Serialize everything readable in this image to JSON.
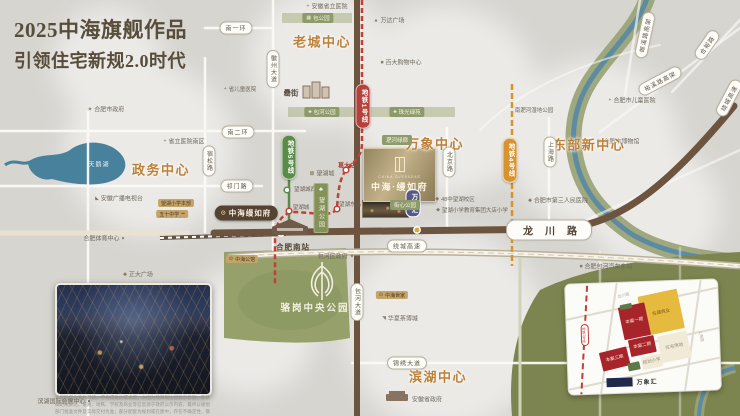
{
  "title": {
    "line1": "2025中海旗舰作品",
    "line2": "引领住宅新规2.0时代"
  },
  "logo": {
    "en": "CHINA OVERSEAS",
    "cn": "中海·缦如府"
  },
  "photo": {
    "caption": "本资料仅为要约邀请，不构成要约或承诺；本图为项目周边配套示意图，非精确距离表达，道路、地铁、学校及商业等信息源于政府公示内容，最终以规划部门批准文件及实际交付为准；部分配套为规划或在建中，存在不确定性，敬请知悉。"
  },
  "inset": {
    "mall_label": "万象汇",
    "metro_label": "地铁1号线",
    "roads": [
      {
        "t": "龙川路",
        "x": 58,
        "y": 13,
        "rot": -12
      },
      {
        "t": "上海路",
        "x": 134,
        "y": 56,
        "rot": 80
      }
    ],
    "parcels": [
      {
        "t": "在建商业",
        "x": 95,
        "y": 31,
        "w": 40,
        "h": 40,
        "c": "#e6b93f",
        "tc": "#7a5a18",
        "rot": -10
      },
      {
        "t": "本案一期",
        "x": 68,
        "y": 39,
        "w": 27,
        "h": 33,
        "c": "#a8242b",
        "tc": "#f7e9da",
        "rot": -10
      },
      {
        "t": "本案二期",
        "x": 75,
        "y": 64,
        "w": 26,
        "h": 17,
        "c": "#a8242b",
        "tc": "#f7e9da",
        "rot": -10
      },
      {
        "t": "本案三期",
        "x": 47,
        "y": 76,
        "w": 28,
        "h": 19,
        "c": "#a8242b",
        "tc": "#f7e9da",
        "rot": -12
      },
      {
        "t": "住宅用地",
        "x": 107,
        "y": 66,
        "w": 30,
        "h": 27,
        "c": "#f1ead6",
        "tc": "#9a8e76",
        "rot": -10
      },
      {
        "t": "规划小学",
        "x": 84,
        "y": 80,
        "w": 20,
        "h": 13,
        "c": "#f1ead6",
        "tc": "#9a8e76",
        "rot": -10
      },
      {
        "t": "",
        "x": 66,
        "y": 84,
        "w": 12,
        "h": 8,
        "c": "#5d7a46",
        "tc": "#ffffff",
        "rot": -10
      },
      {
        "t": "",
        "x": 60,
        "y": 24,
        "w": 12,
        "h": 5,
        "c": "#5d7a46",
        "tc": "#ffffff",
        "rot": -10
      }
    ]
  },
  "map": {
    "labels": [
      {
        "t": "安徽省立医院",
        "i": "+",
        "x": 327,
        "y": 6
      },
      {
        "t": "万达广场",
        "i": "▲",
        "x": 389,
        "y": 20
      },
      {
        "t": "百大购物中心",
        "i": "■",
        "x": 401,
        "y": 62
      },
      {
        "t": "合肥市儿童医院",
        "i": "+",
        "x": 632,
        "y": 100
      },
      {
        "t": "省儿童医院",
        "i": "+",
        "x": 240,
        "y": 89,
        "fs": 5.5
      },
      {
        "t": "合肥市政府",
        "i": "★",
        "x": 106,
        "y": 109
      },
      {
        "t": "省立医院南区",
        "i": "+",
        "x": 184,
        "y": 141
      },
      {
        "t": "安徽广播电视台",
        "i": "◣",
        "x": 119,
        "y": 198
      },
      {
        "t": "合肥体育中心",
        "i2": "●",
        "x": 104,
        "y": 238
      },
      {
        "t": "正大广场",
        "i": "◆",
        "x": 138,
        "y": 274
      },
      {
        "t": "包河区政府",
        "i2": "★",
        "x": 336,
        "y": 256
      },
      {
        "t": "合肥市博物馆",
        "i": "▦",
        "x": 618,
        "y": 141
      },
      {
        "t": "合肥市第三人民医院",
        "i": "◆",
        "x": 558,
        "y": 200
      },
      {
        "t": "南淝河湿地公园",
        "x": 534,
        "y": 110,
        "fs": 5.5
      },
      {
        "t": "合肥包河汽车东站",
        "i": "■",
        "x": 606,
        "y": 266
      },
      {
        "t": "华夏茶博城",
        "i": "◥",
        "x": 400,
        "y": 318
      },
      {
        "t": "安徽省政府",
        "x": 427,
        "y": 399
      },
      {
        "t": "滨湖国际会展中心",
        "i2": "●",
        "x": 64,
        "y": 401
      },
      {
        "t": "48中望湖校区",
        "i": "◆",
        "x": 455,
        "y": 199,
        "fs": 5.5
      },
      {
        "t": "望湖小学教育集团大店小学",
        "i": "◆",
        "x": 472,
        "y": 210,
        "fs": 5.5
      },
      {
        "t": "望湖城",
        "i": "▦",
        "x": 322,
        "y": 173
      },
      {
        "t": "罍街",
        "x": 291,
        "y": 93,
        "fs": 7.5,
        "cls": "poi strong"
      },
      {
        "t": "葛大店",
        "x": 347,
        "y": 165,
        "cls": "rsta"
      },
      {
        "t": "望湖城西",
        "x": 305,
        "y": 189,
        "cls": "sta"
      },
      {
        "t": "望湖城",
        "x": 301,
        "y": 207,
        "cls": "sta"
      },
      {
        "t": "望湖东路",
        "x": 350,
        "y": 204,
        "cls": "sta"
      },
      {
        "t": "合肥南站",
        "x": 293,
        "y": 247,
        "cls": "sta big-sta"
      },
      {
        "t": "老城中心",
        "x": 322,
        "y": 41,
        "cls": "center"
      },
      {
        "t": "万象中心",
        "x": 435,
        "y": 143,
        "cls": "center"
      },
      {
        "t": "东部新中心",
        "x": 589,
        "y": 144,
        "cls": "center"
      },
      {
        "t": "政务中心",
        "x": 161,
        "y": 169,
        "cls": "center"
      },
      {
        "t": "滨湖中心",
        "x": 438,
        "y": 376,
        "cls": "center"
      },
      {
        "t": "骆岗中央公园",
        "x": 315,
        "y": 307,
        "cls": "park-title"
      },
      {
        "t": "天鹅湖",
        "x": 99,
        "y": 164,
        "cls": "lake-title"
      },
      {
        "t": "南一环",
        "x": 236,
        "y": 28,
        "cls": "hp"
      },
      {
        "t": "南二环",
        "x": 238,
        "y": 132,
        "cls": "hp"
      },
      {
        "t": "祁门路",
        "x": 237,
        "y": 186,
        "cls": "hp"
      },
      {
        "t": "绕城高速",
        "x": 407,
        "y": 246,
        "cls": "hp"
      },
      {
        "t": "锦绣大道",
        "x": 407,
        "y": 363,
        "cls": "hp"
      },
      {
        "t": "龙川路",
        "x": 549,
        "y": 230,
        "cls": "hp big"
      },
      {
        "t": "徽州大道",
        "x": 273,
        "y": 69,
        "cls": "vp"
      },
      {
        "t": "宿松路",
        "x": 209,
        "y": 161,
        "cls": "vp"
      },
      {
        "t": "包河大道",
        "x": 357,
        "y": 302,
        "cls": "vp"
      },
      {
        "t": "北京路",
        "x": 449,
        "y": 162,
        "cls": "vp"
      },
      {
        "t": "上海路",
        "x": 550,
        "y": 152,
        "cls": "vp"
      },
      {
        "t": "郎溪路高架",
        "x": 645,
        "y": 35,
        "cls": "hp",
        "rot": -78
      },
      {
        "t": "裕溪路高架",
        "x": 660,
        "y": 81,
        "cls": "hp",
        "rot": -28
      },
      {
        "t": "合裕路",
        "x": 707,
        "y": 45,
        "cls": "hp",
        "rot": -55
      },
      {
        "t": "绕城高速",
        "x": 729,
        "y": 98,
        "cls": "hp",
        "rot": -62
      },
      {
        "t": "地铁1号线",
        "x": 363,
        "y": 106,
        "cls": "metro",
        "c": "#b5413a"
      },
      {
        "t": "地铁5号线",
        "x": 289,
        "y": 157,
        "cls": "metro",
        "c": "#5b8a4a"
      },
      {
        "t": "地铁4号线",
        "x": 510,
        "y": 160,
        "cls": "metro",
        "c": "#d6932f"
      },
      {
        "t": "万象汇",
        "x": 413,
        "y": 203,
        "cls": "mall-pill"
      },
      {
        "t": "包公园",
        "i": "▦",
        "x": 318,
        "y": 18,
        "cls": "pp"
      },
      {
        "t": "包河公园",
        "i": "♣",
        "x": 322,
        "y": 112,
        "cls": "pp"
      },
      {
        "t": "珠光绿苑",
        "i": "♣",
        "x": 407,
        "y": 112,
        "cls": "pp"
      },
      {
        "t": "淝河绿廊",
        "x": 397,
        "y": 140,
        "cls": "pp"
      },
      {
        "t": "街心公园",
        "x": 405,
        "y": 205,
        "cls": "pp"
      },
      {
        "t": "望湖公园",
        "i": "♣",
        "x": 321,
        "y": 208,
        "cls": "park-block"
      },
      {
        "t": "望湖小学本部",
        "x": 176,
        "y": 203,
        "cls": "gp"
      },
      {
        "t": "五十中学",
        "i2": "▪▪",
        "x": 172,
        "y": 214,
        "cls": "gp"
      },
      {
        "t": "中海公馆",
        "i": "⊙",
        "x": 242,
        "y": 259,
        "cls": "gp"
      },
      {
        "t": "中海世家",
        "i": "⊙",
        "x": 392,
        "y": 295,
        "cls": "gp"
      },
      {
        "t": "中海缦如府",
        "i": "⊙",
        "x": 246,
        "y": 213,
        "cls": "dp"
      }
    ]
  },
  "colors": {
    "metro1": "#b5413a",
    "metro4": "#d6932f",
    "metro5": "#5b8a4a",
    "main_road": "#6d543f",
    "park": "#95a06b",
    "water": "#47819b",
    "accent": "#bc8038"
  }
}
